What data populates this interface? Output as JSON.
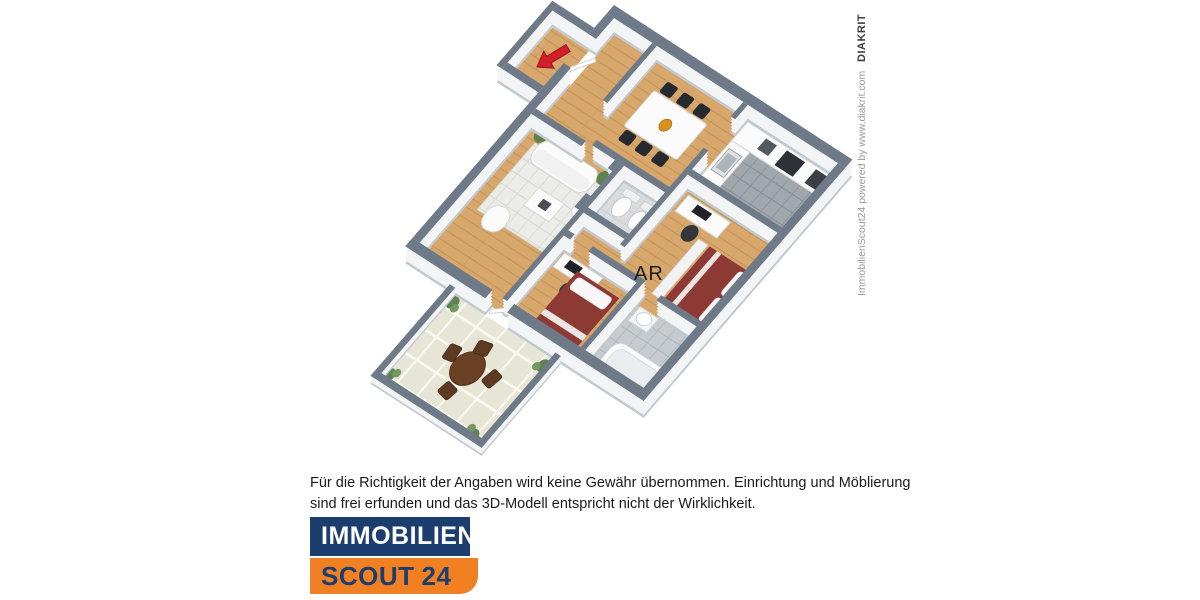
{
  "page": {
    "background": "#ffffff"
  },
  "floorplan": {
    "labels": {
      "storage_room": "AR"
    },
    "colors": {
      "wall_top": "#6e7a87",
      "wall_face": "#f2f4f5",
      "wall_base": "#c2c9cf",
      "wood_floor": "#d7a76b",
      "kitchen_floor": "#a0a7ad",
      "bathroom_floor": "#c6cbd0",
      "wc_floor": "#dadde0",
      "terrace_tile": "#e7e5d6",
      "rug": "#ebece7",
      "bed": "#8e3a34",
      "entrance_arrow": "#d1202a",
      "plant": "#5e8350",
      "terrace_furniture": "#6a4124"
    }
  },
  "watermark": {
    "credit": "ImmobilienScout24 powered by www.diakrit.com",
    "brand": "DIAKRIT"
  },
  "disclaimer": {
    "line1": "Für die Richtigkeit der Angaben wird keine Gewähr übernommen. Einrichtung und Möblierung",
    "line2": "sind frei erfunden und das 3D-Modell entspricht nicht der Wirklichkeit."
  },
  "logo": {
    "line1": "IMMOBILIEN",
    "line2_word": "SCOUT",
    "line2_number": "24",
    "navy": "#1c3e6e",
    "orange": "#f08021"
  }
}
